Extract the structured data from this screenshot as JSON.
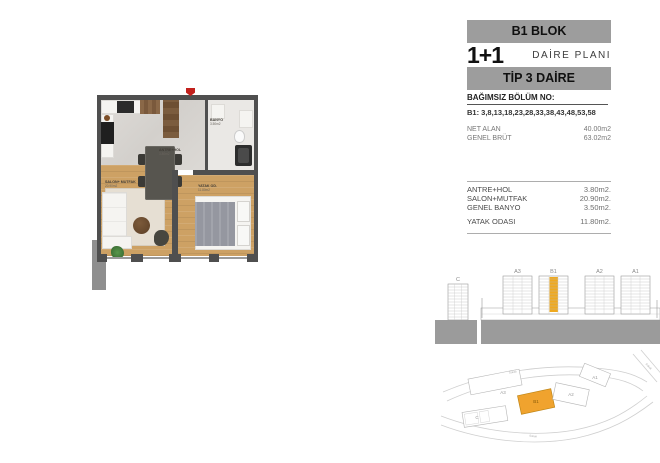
{
  "header": {
    "block": "B1 BLOK",
    "unit_type": "1+1",
    "unit_type_label": "DAİRE PLANI",
    "tip": "TİP 3 DAİRE"
  },
  "info": {
    "section_label": "BAĞIMSIZ BÖLÜM NO:",
    "section_value": "B1: 3,8,13,18,23,28,33,38,43,48,53,58",
    "summary": [
      {
        "label": "NET ALAN",
        "value": "40.00m2"
      },
      {
        "label": "GENEL BRÜT",
        "value": "63.02m2"
      }
    ],
    "rooms": [
      {
        "label": "ANTRE+HOL",
        "value": "3.80m2."
      },
      {
        "label": "SALON+MUTFAK",
        "value": "20.90m2."
      },
      {
        "label": "GENEL BANYO",
        "value": "3.50m2."
      },
      {
        "label": "YATAK ODASI",
        "value": "11.80m2."
      }
    ]
  },
  "floorplan": {
    "labels": [
      {
        "name": "SALON+ MUTFAK",
        "area": "20.90m2"
      },
      {
        "name": "ANTRE+HOL",
        "area": "3.80m2"
      },
      {
        "name": "BANYO",
        "area": "3.50m2"
      },
      {
        "name": "YATAK OD.",
        "area": "11.80m2"
      }
    ]
  },
  "elevation": {
    "left_building": "C",
    "buildings": [
      "A3",
      "B1",
      "A2",
      "A1"
    ],
    "highlighted": "B1"
  },
  "siteplan": {
    "blocks": [
      "A3",
      "B1",
      "A2",
      "A1",
      "C"
    ],
    "highlighted": "B1",
    "road_label": "Sokak"
  },
  "colors": {
    "highlight_orange": "#F0A32E",
    "header_bar_gray": "#9D9D9D",
    "wall_gray": "#4F4F4F"
  }
}
